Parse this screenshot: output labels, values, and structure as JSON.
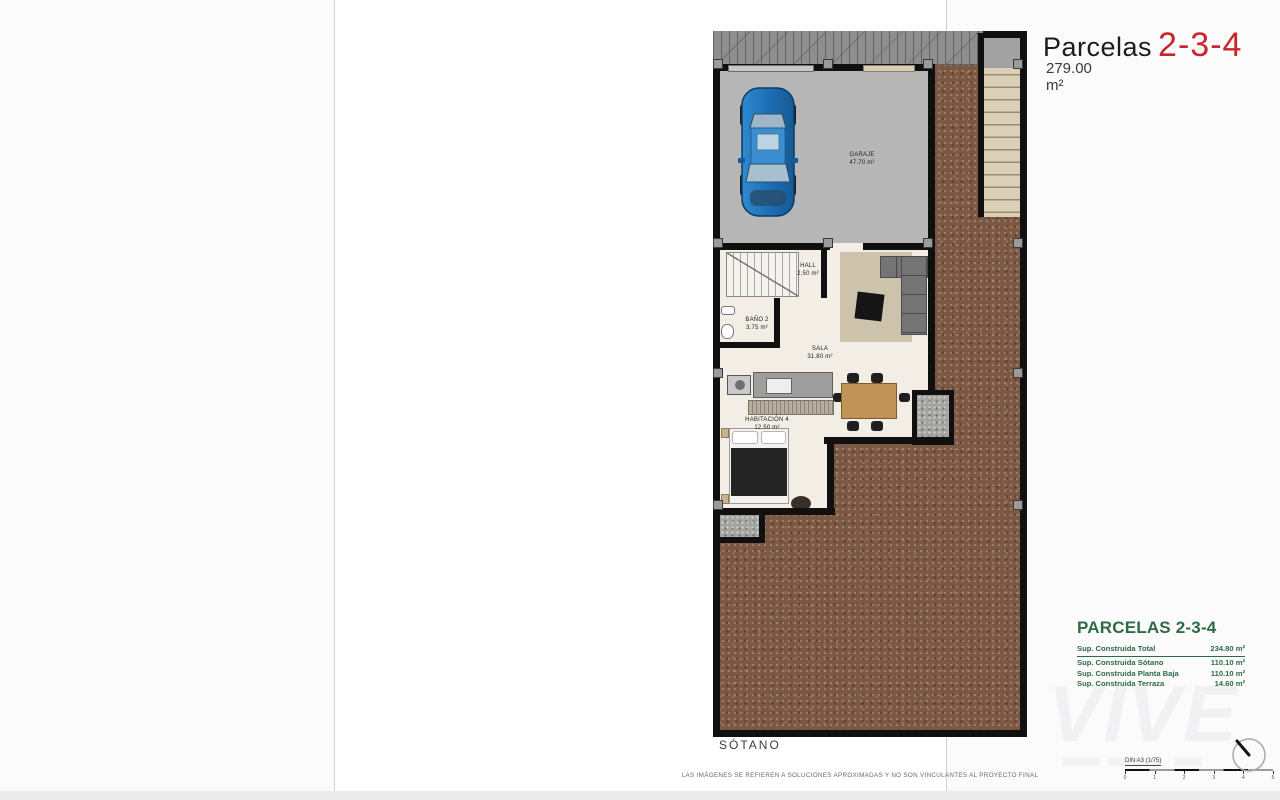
{
  "page": {
    "header": {
      "title_prefix": "Parcelas",
      "title_number": "2-3-4",
      "area": "279.00 m²"
    },
    "plan": {
      "rooms": [
        {
          "id": "garaje",
          "label": "GARAJE",
          "area": "47.70 m²"
        },
        {
          "id": "hall",
          "label": "HALL",
          "area": "2.50 m²"
        },
        {
          "id": "bano2",
          "label": "BAÑO 2",
          "area": "3.75 m²"
        },
        {
          "id": "sala",
          "label": "SALA",
          "area": "31.80 m²"
        },
        {
          "id": "habitacion4",
          "label": "HABITACIÓN 4",
          "area": "12.50 m²"
        }
      ]
    },
    "summary": {
      "title": "PARCELAS 2-3-4",
      "rows": [
        {
          "label": "Sup. Construida Total",
          "value": "234.80 m²"
        },
        {
          "label": "Sup. Construida Sótano",
          "value": "110.10 m²"
        },
        {
          "label": "Sup. Construida Planta Baja",
          "value": "110.10 m²"
        },
        {
          "label": "Sup. Construida Terraza",
          "value": "14.60 m²"
        }
      ]
    },
    "footer": {
      "floor_label": "SÓTANO",
      "disclaimer": "LAS IMÁGENES SE REFIEREN A SOLUCIONES APROXIMADAS Y NO SON VINCULANTES AL PROYECTO FINAL",
      "scale_label": "DIN A3 (1/75)",
      "scale_ticks": [
        "0",
        "1",
        "2",
        "3",
        "4",
        "5"
      ]
    },
    "watermark": "VIVE",
    "colors": {
      "title_red": "#c9252c",
      "summary_green": "#2d6a45",
      "terrain_brown": "#7a5843",
      "garage_floor": "#b6b6b7",
      "car_blue": "#1d6fb5"
    }
  }
}
